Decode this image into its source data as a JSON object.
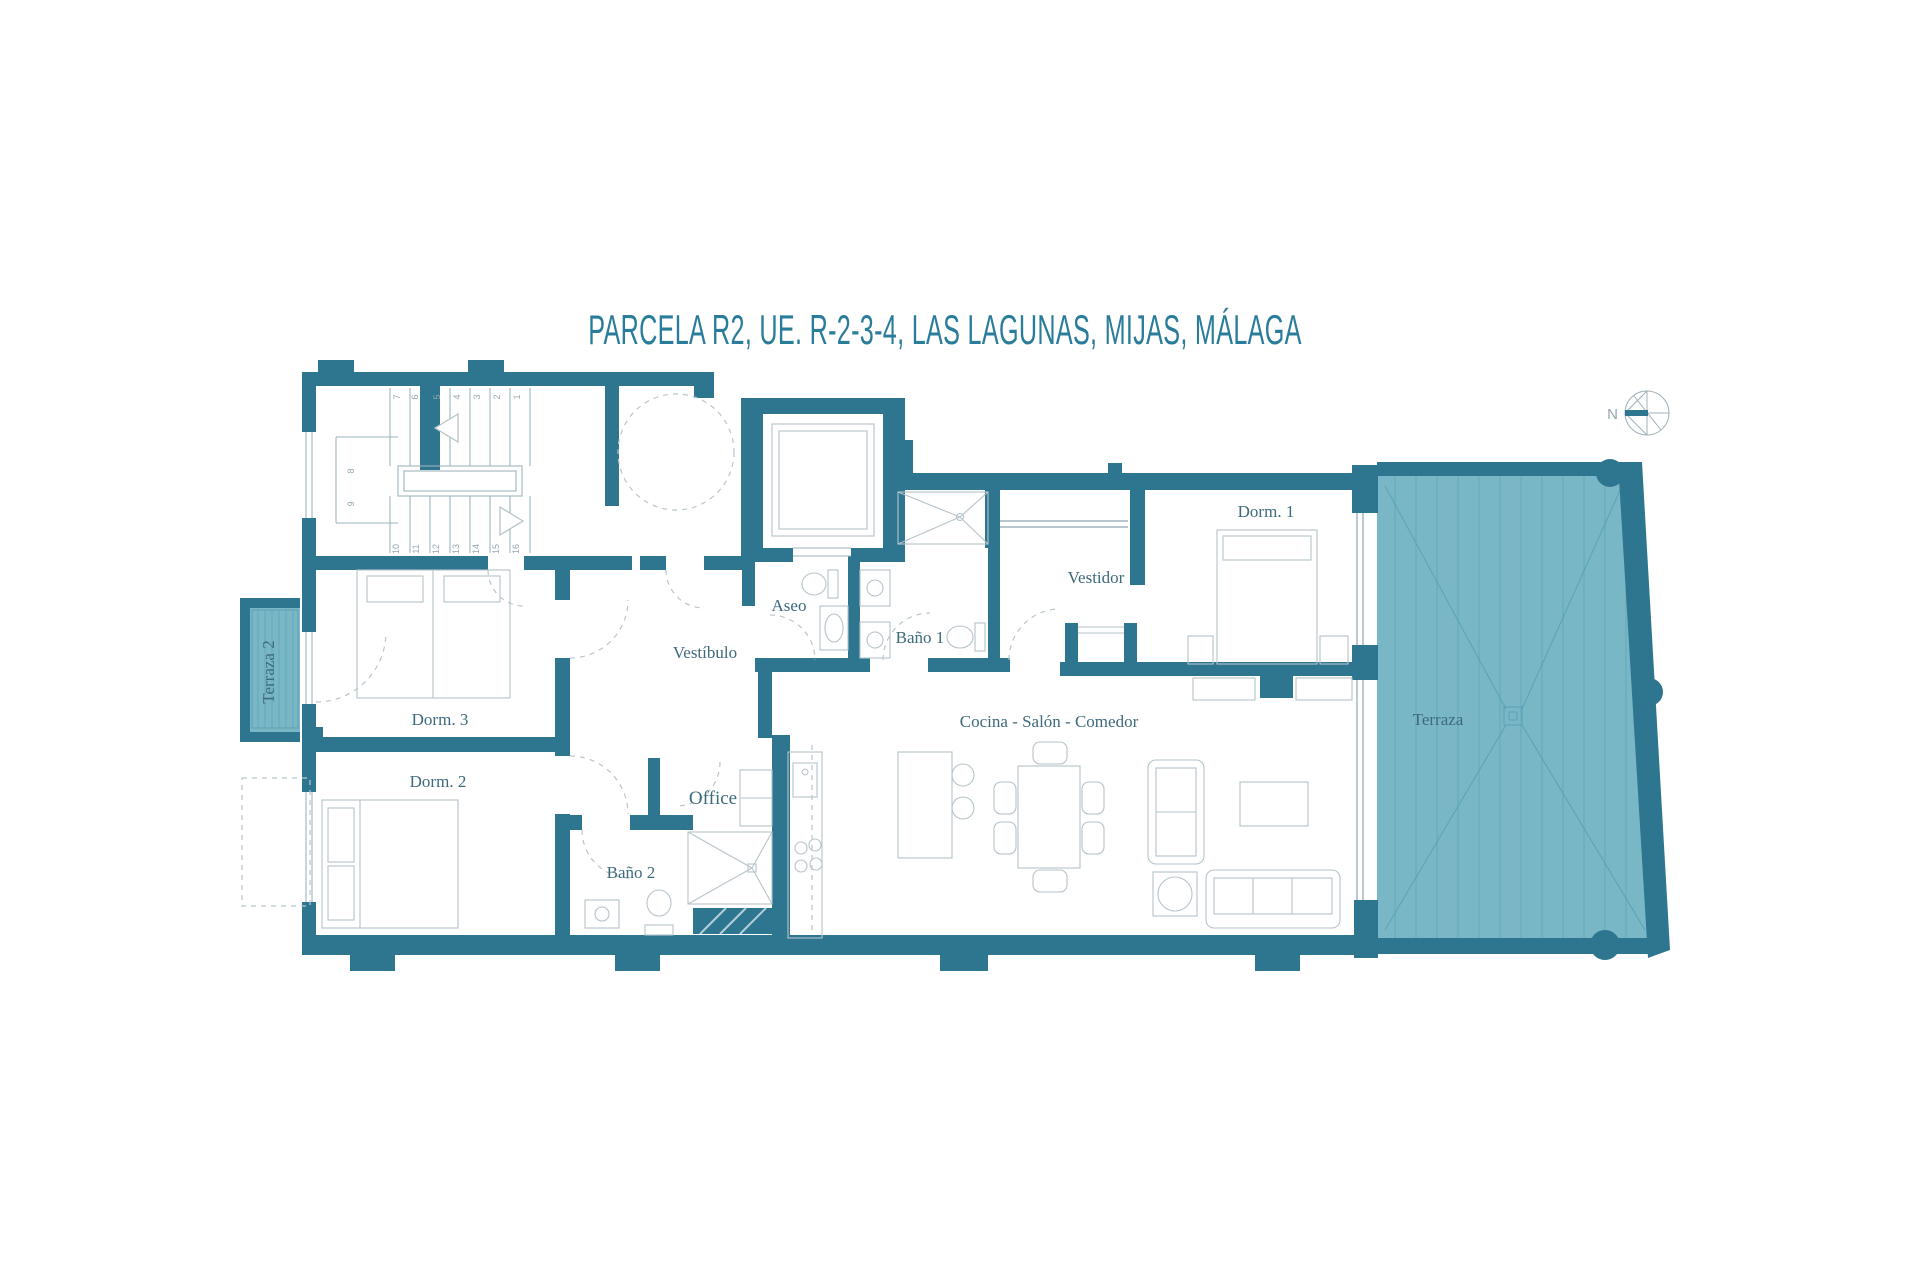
{
  "title": "PARCELA R2, UE. R-2-3-4, LAS LAGUNAS, MIJAS, MÁLAGA",
  "compass": {
    "label": "N"
  },
  "rooms": {
    "dorm1": "Dorm. 1",
    "dorm2": "Dorm. 2",
    "dorm3": "Dorm. 3",
    "vestidor": "Vestidor",
    "vestibulo": "Vestíbulo",
    "aseo": "Aseo",
    "bano1": "Baño 1",
    "bano2": "Baño 2",
    "office": "Office",
    "cocina_salon_comedor": "Cocina - Salón - Comedor",
    "terraza": "Terraza",
    "terraza2": "Terraza 2"
  },
  "stairs": {
    "steps": [
      "1",
      "2",
      "3",
      "4",
      "5",
      "6",
      "7",
      "8",
      "9",
      "10",
      "11",
      "12",
      "13",
      "14",
      "15",
      "16"
    ]
  },
  "colors": {
    "wall": "#2e7590",
    "terrace_fill": "#79b7c6",
    "terrace_line": "#559cb2",
    "label_text": "#3d6a7c",
    "title_text": "#2a7c9b",
    "furniture_line": "#b6c3ca",
    "dashed_line": "#b9c6cc"
  }
}
